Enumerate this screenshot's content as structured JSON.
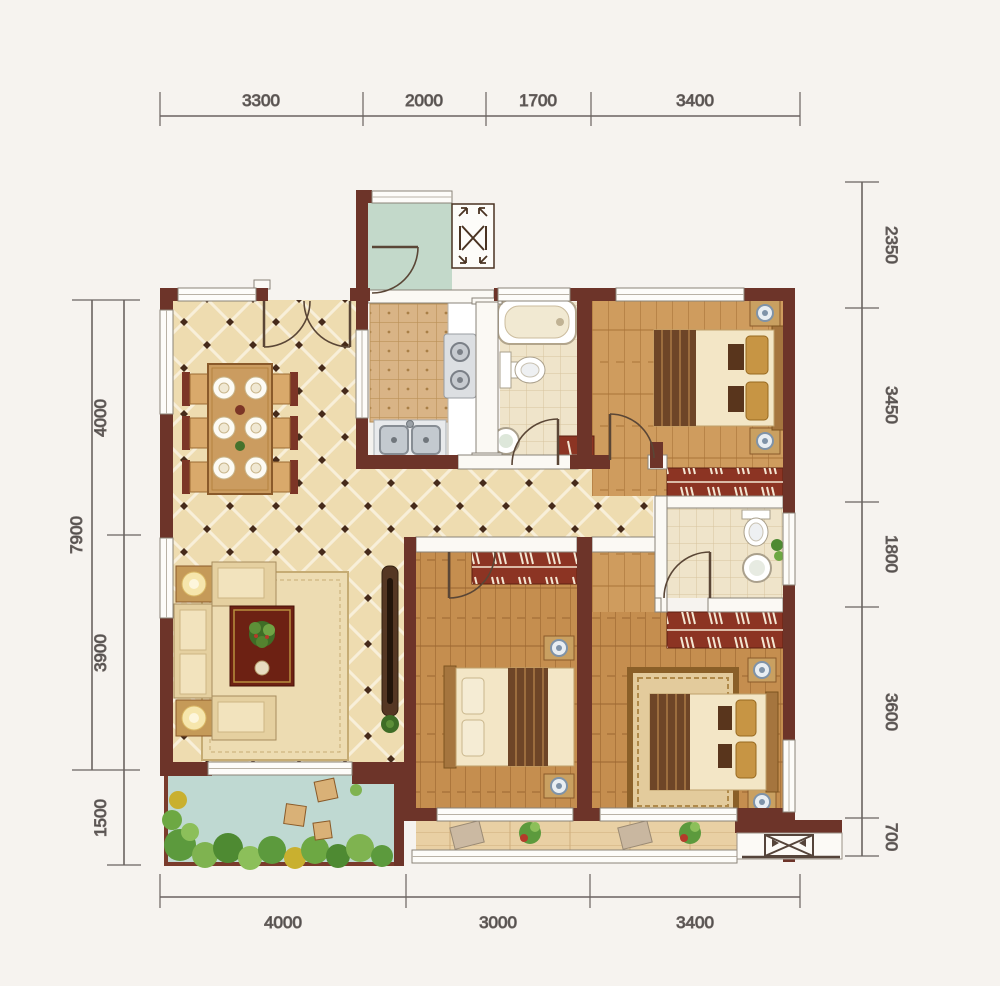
{
  "plan": {
    "type": "residential-floor-plan",
    "dimensions": {
      "top": [
        "3300",
        "2000",
        "1700",
        "3400"
      ],
      "bottom": [
        "4000",
        "3000",
        "3400"
      ],
      "right": [
        "2350",
        "3450",
        "1800",
        "3600",
        "700"
      ],
      "left_outer": [
        "7900"
      ],
      "left_inner": [
        "4000",
        "3900",
        "1500"
      ]
    },
    "colors": {
      "background": "#f6f3ef",
      "exterior_wall": "#6d3429",
      "interior_wall": "#fbf9f4",
      "living_tile": "#eedcb0",
      "wood_floor_light": "#cf9c5e",
      "wood_floor_mid": "#c58e4f",
      "bath_tile": "#efe4ca",
      "kitchen_mat": "#d9b486",
      "balcony_left_floor": "#bfd9d2",
      "balcony_bottom_floor": "#e9d0a4",
      "utility_floor": "#c3d9ca",
      "wardrobe": "#8c3423",
      "dimension_line": "#6a6360"
    }
  }
}
